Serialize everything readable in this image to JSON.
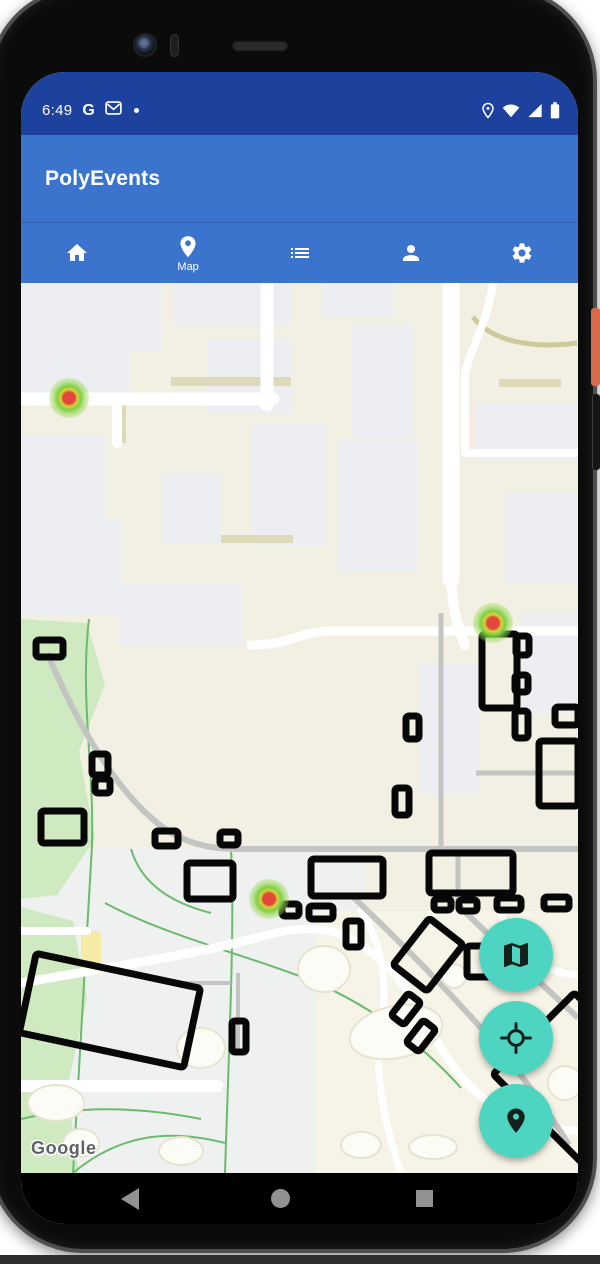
{
  "colors": {
    "status-bar": "#1d429e",
    "app-bar": "#3a74cd",
    "fab-teal": "#4ed5c2",
    "heat-center": "#e2473b",
    "heat-mid": "#d9d23a",
    "heat-outer": "#7fd044"
  },
  "status_bar": {
    "time": "6:49",
    "google_g": "G",
    "left_icons": [
      "google-g",
      "gmail",
      "notification-dot"
    ],
    "right_icons": [
      "location",
      "wifi",
      "cell-signal",
      "battery"
    ]
  },
  "app_bar": {
    "title": "PolyEvents"
  },
  "tab_bar": {
    "tabs": [
      {
        "name": "home",
        "label": "",
        "selected": false
      },
      {
        "name": "map",
        "label": "Map",
        "selected": true
      },
      {
        "name": "list",
        "label": "",
        "selected": false
      },
      {
        "name": "profile",
        "label": "",
        "selected": false
      },
      {
        "name": "settings",
        "label": "",
        "selected": false
      }
    ]
  },
  "map": {
    "watermark": "Google",
    "heat_markers": [
      {
        "x_pct": 8.6,
        "y_pct": 12.9
      },
      {
        "x_pct": 84.7,
        "y_pct": 38.2
      },
      {
        "x_pct": 44.5,
        "y_pct": 69.2
      }
    ],
    "fabs": [
      {
        "name": "map-type"
      },
      {
        "name": "my-location"
      },
      {
        "name": "place-marker"
      }
    ]
  },
  "nav_bar": {
    "buttons": [
      "back",
      "home",
      "recents"
    ]
  }
}
